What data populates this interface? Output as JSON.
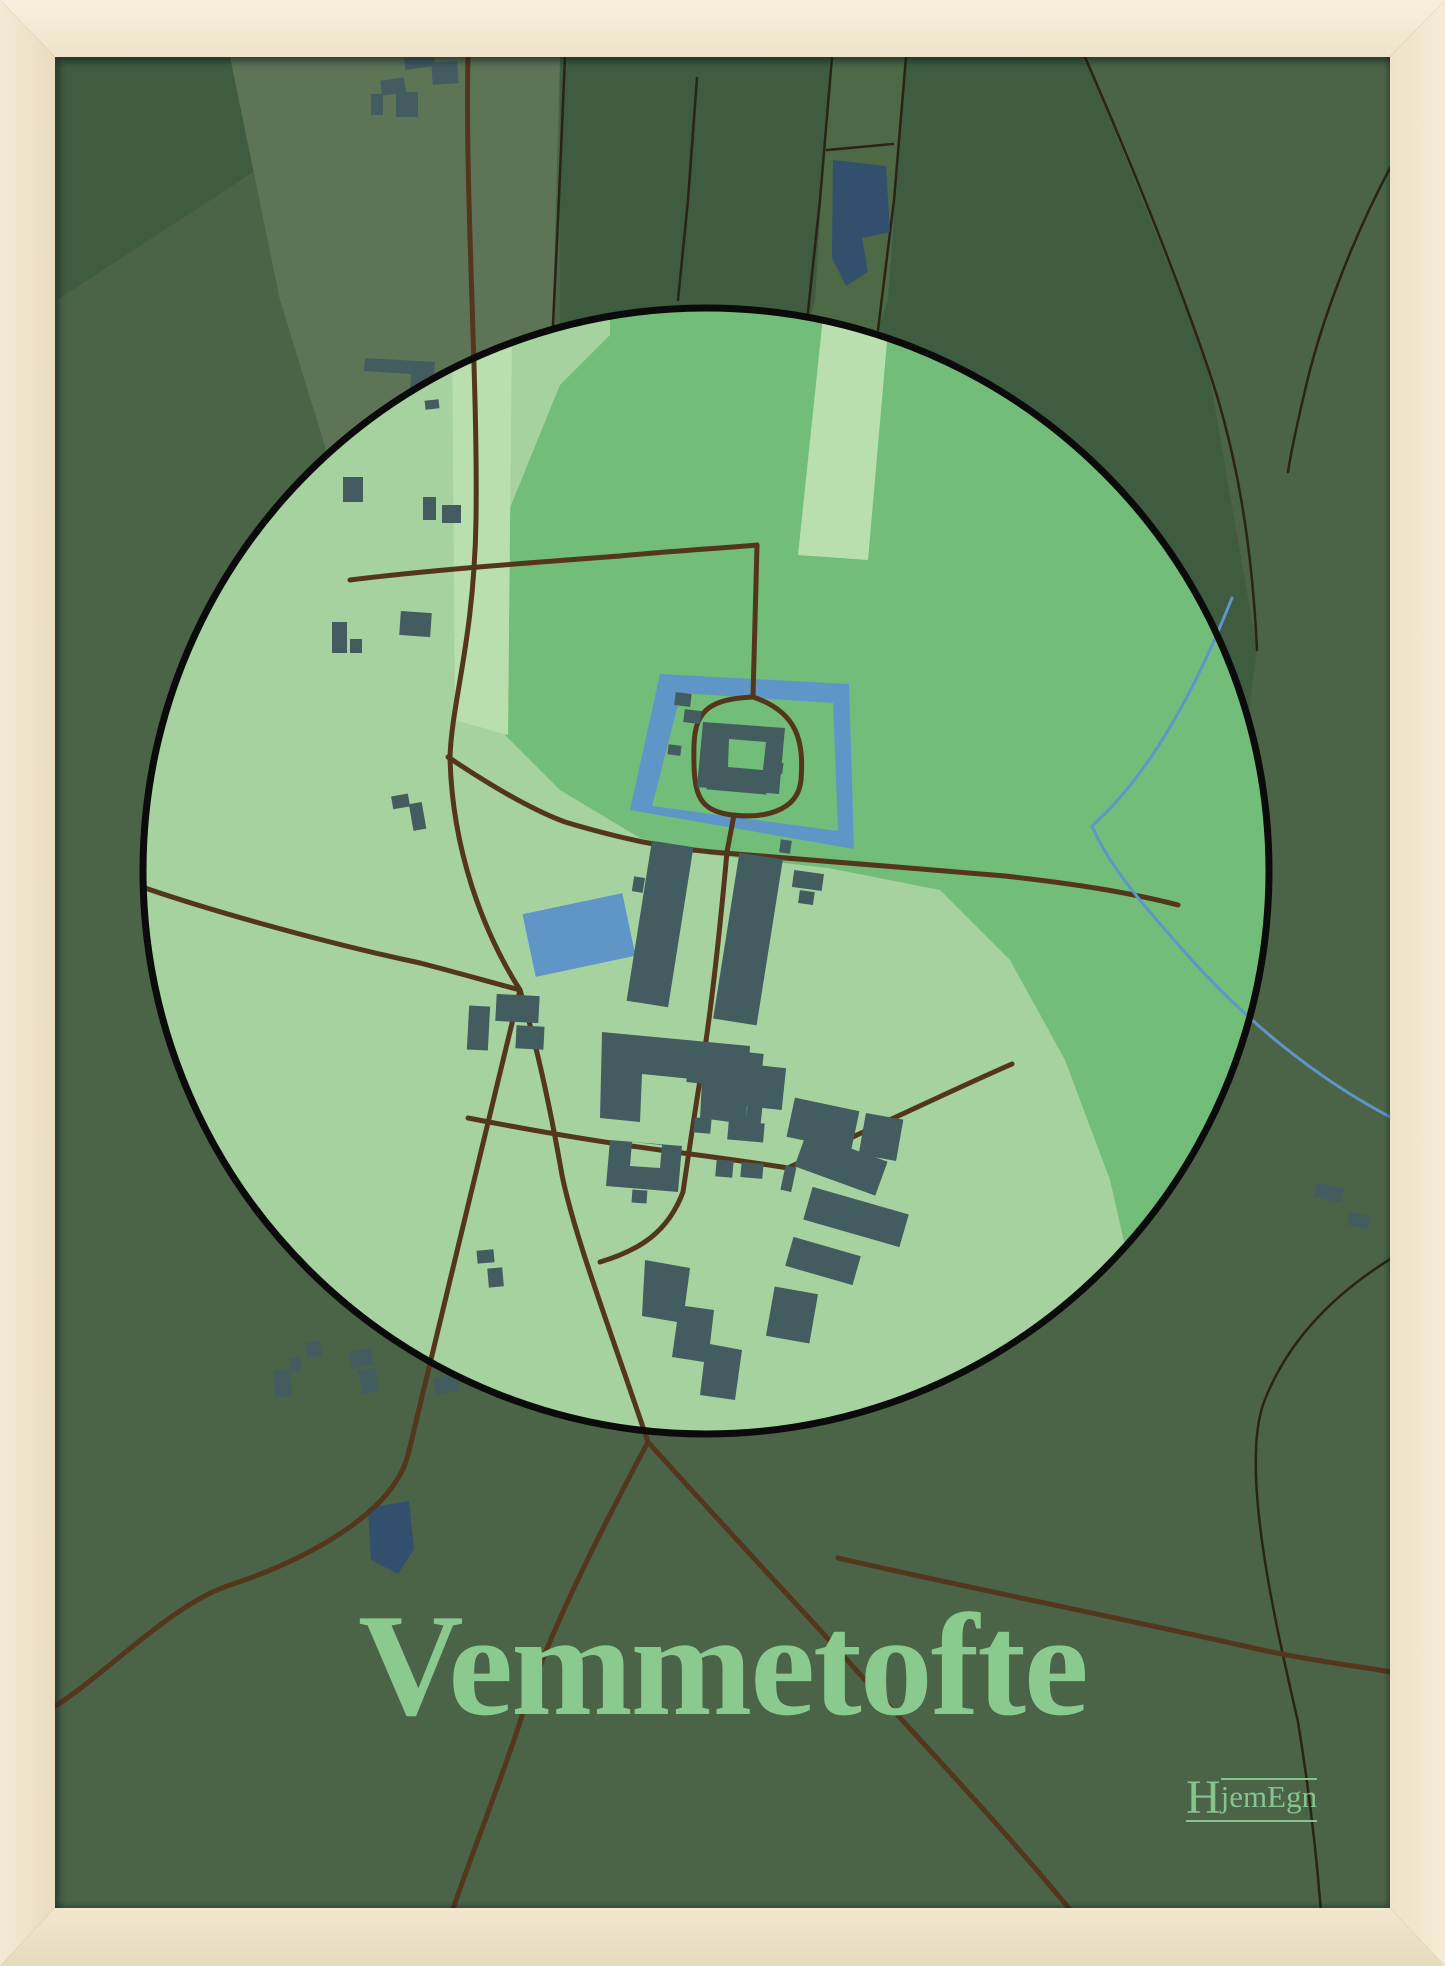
{
  "poster": {
    "title": "Vemmetofte"
  },
  "logo": {
    "initial": "H",
    "rest": "jemEgn"
  },
  "colors": {
    "frame_wood": "#f0e4cb",
    "map_base": "#4b6447",
    "map_dark": "#3f5b40",
    "map_band": "#5e7457",
    "map_alt": "#4d6946",
    "circle_fill": "#a6d2a0",
    "circle_medium": "#72bd7a",
    "circle_strip": "#b9dfae",
    "circle_outline": "#0b0b0b",
    "road_major": "#54361d",
    "road_minor": "#2b2316",
    "water": "#6095c8",
    "water_dark": "#324f6e",
    "building": "#435c60",
    "title_text": "#8bca8f",
    "logo_text": "#86c48d"
  },
  "map": {
    "place": "Vemmetofte",
    "style": "circle-focus poster map",
    "features": [
      "focus-circle",
      "castle-moat",
      "castle-island",
      "castle-building",
      "village-buildings",
      "village-pond",
      "lakes",
      "road-network",
      "stream",
      "field-regions"
    ]
  }
}
